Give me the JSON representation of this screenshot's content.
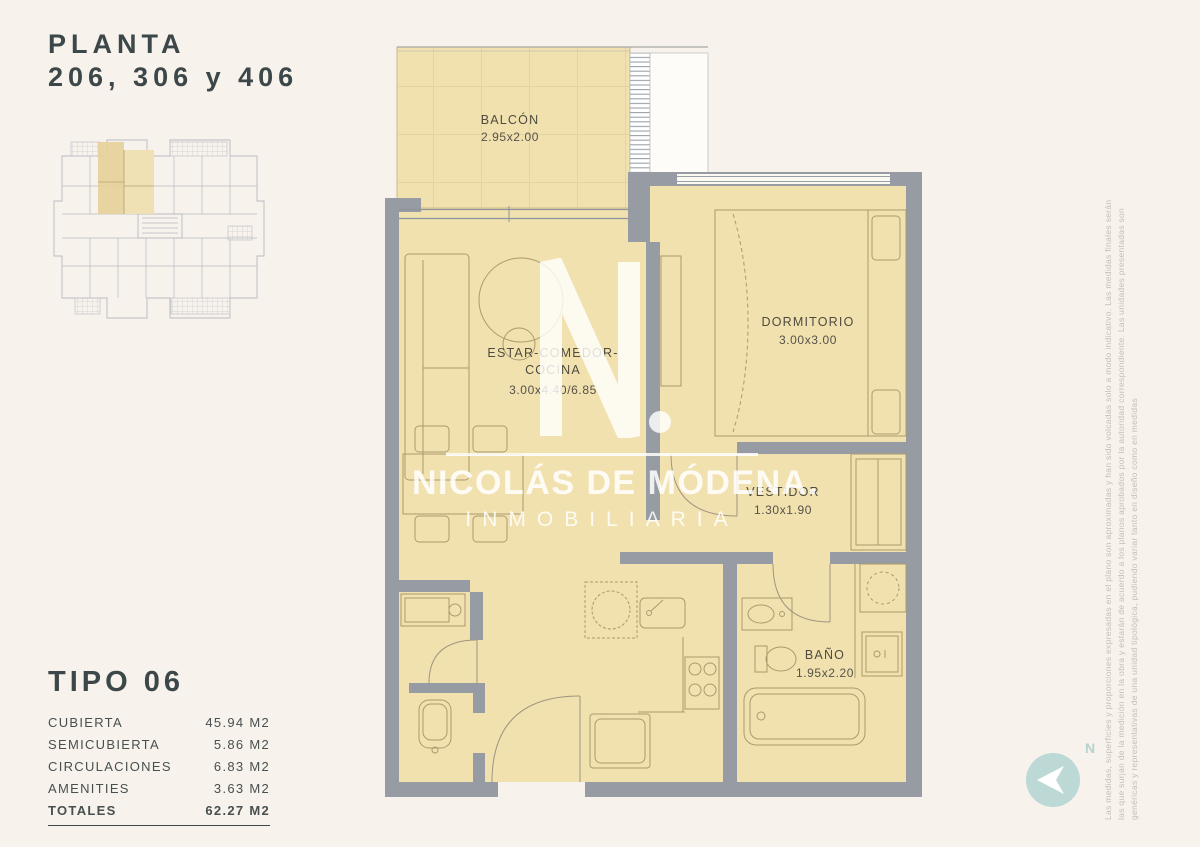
{
  "page": {
    "title_line1": "PLANTA",
    "title_line2": "206, 306 y 406"
  },
  "unit_info": {
    "type_label": "TIPO 06",
    "areas": [
      {
        "label": "CUBIERTA",
        "value": "45.94 M2"
      },
      {
        "label": "SEMICUBIERTA",
        "value": "5.86 M2"
      },
      {
        "label": "CIRCULACIONES",
        "value": "6.83 M2"
      },
      {
        "label": "AMENITIES",
        "value": "3.63 M2"
      }
    ],
    "total": {
      "label": "TOTALES",
      "value": "62.27 M2"
    }
  },
  "floorplan": {
    "rooms": [
      {
        "label_lines": [
          "BALCÓN"
        ],
        "dims": "2.95x2.00"
      },
      {
        "label_lines": [
          "ESTAR-COMEDOR-",
          "COCINA"
        ],
        "dims": "3.00x4.40/6.85"
      },
      {
        "label_lines": [
          "DORMITORIO"
        ],
        "dims": "3.00x3.00"
      },
      {
        "label_lines": [
          "VESTIDOR"
        ],
        "dims": "1.30x1.90"
      },
      {
        "label_lines": [
          "BAÑO"
        ],
        "dims": "1.95x2.20"
      }
    ]
  },
  "watermark": {
    "monogram": "N.",
    "brand": "NICOLÁS DE MÓDENA.",
    "tagline": "INMOBILIARIA"
  },
  "disclaimer": {
    "lines": [
      "Las medidas, superficies y proporciones expresadas en el plano son aproximadas y han sido volcadas solo a modo indicativo. Las medidas finales serán",
      "las que surjan de la medición en la obra y estarán de acuerdo a los planos aprobados por la autoridad correspondiente. Las unidades presentadas son",
      "genéricas y representativas de una unidad tipológica, pudiendo variar tanto en diseño como en medidas"
    ]
  },
  "compass": {
    "north_label": "N"
  },
  "colors": {
    "background": "#f8f2ec",
    "room_fill": "#f1e1ae",
    "wall": "#979ca4",
    "highlight_unit": "#e7d29c",
    "furniture_line": "#ab9a6e",
    "compass_teal": "#bcd9d6",
    "ink": "#3c4749"
  }
}
